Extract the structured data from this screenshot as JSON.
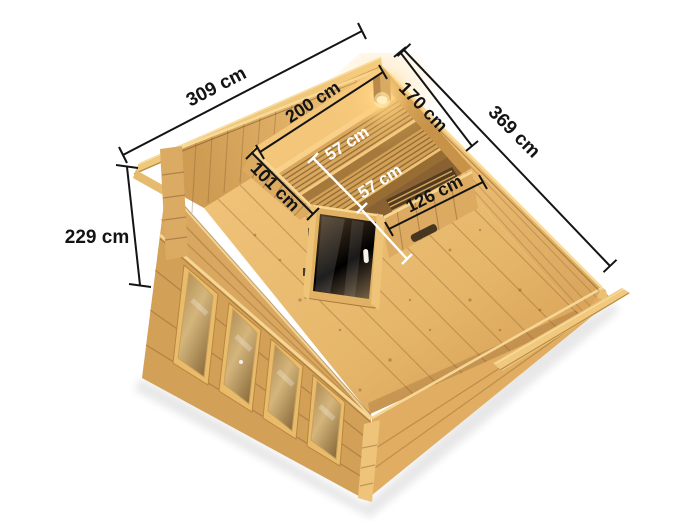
{
  "title": "Sauna garden house top view with dimensions",
  "dims": {
    "overall_width": "309 cm",
    "overall_depth": "369 cm",
    "wall_height": "229 cm",
    "sauna_side_nw": "200 cm",
    "sauna_side_ne": "170 cm",
    "partition_left": "101 cm",
    "partition_right": "126 cm",
    "bench_upper": "57 cm",
    "bench_lower": "57 cm"
  },
  "colors": {
    "background": "#ffffff",
    "dimension_line": "#141414",
    "dimension_line_light": "#ffffff",
    "wood_light": "#f0c87c",
    "wood_mid": "#d9a75f",
    "wood_dark": "#8f6836",
    "door_glass": "#5d4a31",
    "lamp_glow": "#ffdf9b"
  }
}
